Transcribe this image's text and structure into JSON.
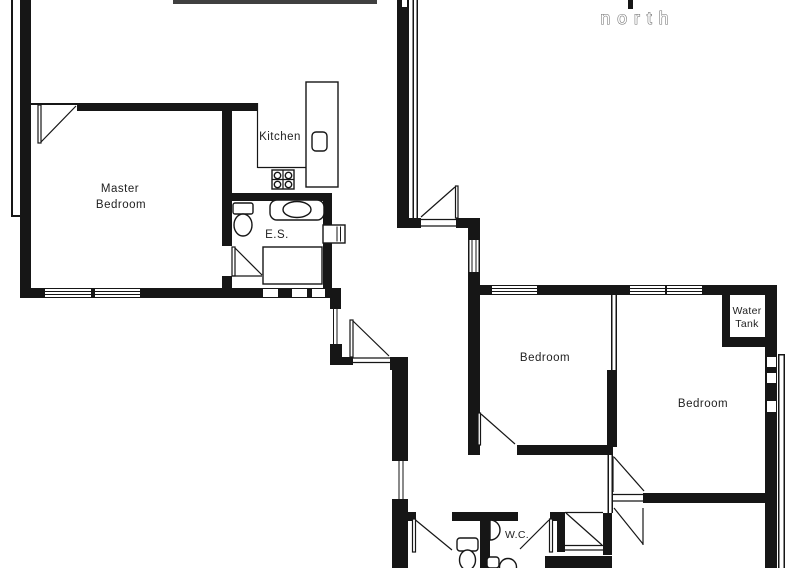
{
  "compass": {
    "label": "north"
  },
  "rooms": {
    "master_bedroom": {
      "label_lines": [
        "Master",
        "Bedroom"
      ]
    },
    "kitchen": {
      "label": "Kitchen"
    },
    "ensuite": {
      "label": "E.S."
    },
    "bedroom_1": {
      "label": "Bedroom"
    },
    "bedroom_2": {
      "label": "Bedroom"
    },
    "water_tank": {
      "label_lines": [
        "Water",
        "Tank"
      ]
    },
    "wc": {
      "label": "W.C."
    }
  },
  "colors": {
    "paper": "#ffffff",
    "wall": "#161616",
    "text": "#1f1f1f",
    "north_outline": "#6f6f6f"
  }
}
